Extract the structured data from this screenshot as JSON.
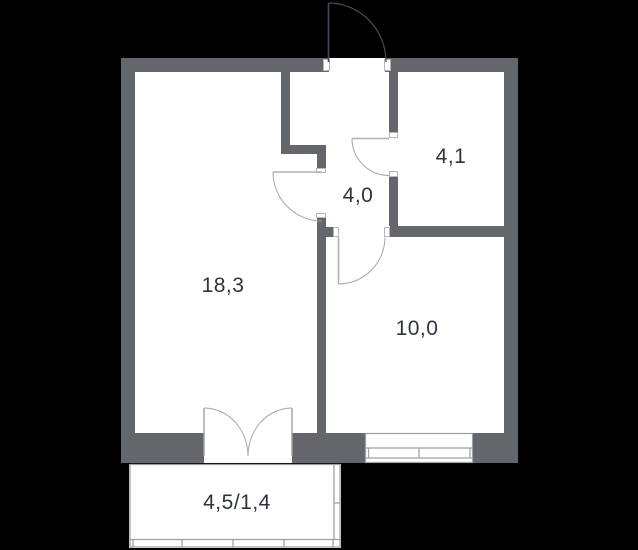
{
  "plan": {
    "type": "apartment-floor-plan",
    "colors": {
      "background": "#000000",
      "wall": "#63666b",
      "floor": "#ffffff",
      "label_text": "#2e343d",
      "thin_line": "#9aa0a6",
      "interior_door_arc": "#a3a6ab",
      "entry_door_line": "#454a54"
    },
    "rooms": [
      {
        "id": "living-room",
        "area_label": "18,3"
      },
      {
        "id": "hallway",
        "area_label": "4,0"
      },
      {
        "id": "bathroom",
        "area_label": "4,1"
      },
      {
        "id": "bedroom",
        "area_label": "10,0"
      },
      {
        "id": "balcony",
        "area_label": "4,5/1,4"
      }
    ]
  }
}
